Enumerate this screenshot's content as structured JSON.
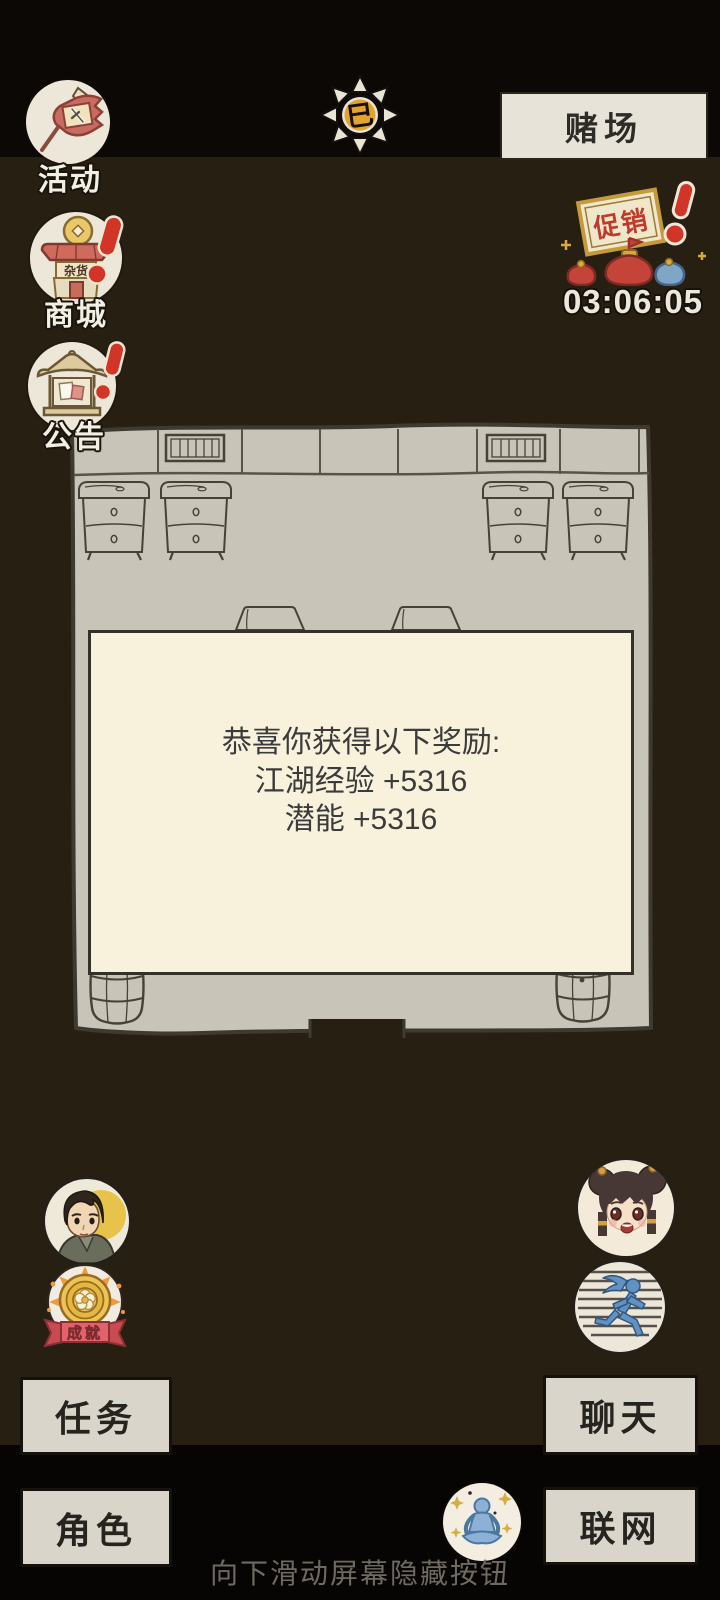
{
  "colors": {
    "background_brown": "#281f13",
    "top_band": "#0b0806",
    "bottom_band": "#070504",
    "room_fill": "#c9c4b8",
    "sketch_line": "#454035",
    "dialog_bg": "#f8f2dc",
    "button_face": "#d9d5cb",
    "alert_red": "#d03528",
    "gold": "#e0a62e",
    "ribbon_pink": "#e2626b",
    "runner_blue": "#6292c4",
    "meditate_blue": "#8cb0d6"
  },
  "hud": {
    "activity": {
      "label": "活动"
    },
    "shop": {
      "label": "商城",
      "sign_text": "杂货"
    },
    "notice": {
      "label": "公告"
    },
    "casino": {
      "label": "赌场"
    },
    "time_icon": {
      "glyph": "巳"
    },
    "promo": {
      "sign_text": "促销",
      "countdown": "03:06:05"
    },
    "achievement": {
      "label": "成就"
    }
  },
  "reward_dialog": {
    "title": "恭喜你获得以下奖励:",
    "rewards": [
      "江湖经验 +5316",
      "潜能 +5316"
    ]
  },
  "menu_buttons": {
    "tasks": "任务",
    "chat": "聊天",
    "character": "角色",
    "network": "联网"
  },
  "hint": "向下滑动屏幕隐藏按钮"
}
